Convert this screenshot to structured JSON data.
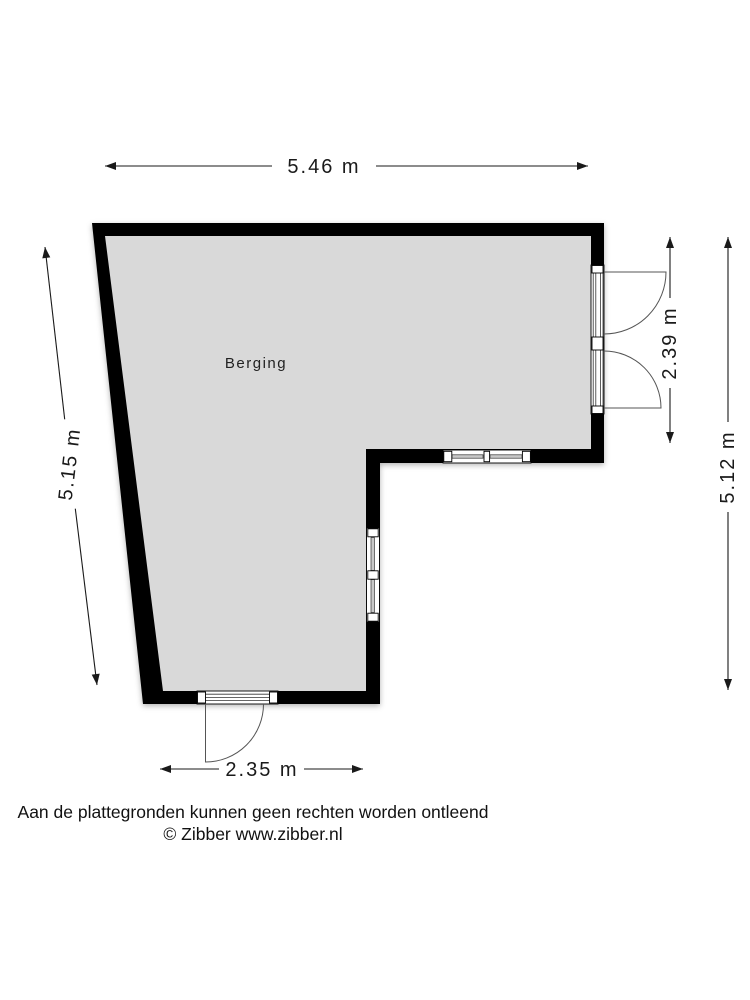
{
  "plan": {
    "room_label": "Berging",
    "colors": {
      "wall": "#000000",
      "floor": "#d9d9d9",
      "dimension": "#1a1a1a"
    },
    "dimensions": {
      "top": "5.46 m",
      "left": "5.15 m",
      "right_inner": "2.39 m",
      "right_outer": "5.12 m",
      "bottom": "2.35 m"
    },
    "features": [
      "double outward swing doors (right wall)",
      "window (inner horizontal wall)",
      "window (inner vertical wall)",
      "single outward swing door (bottom wall)"
    ]
  },
  "footer": {
    "disclaimer": "Aan de plattegronden kunnen geen rechten worden ontleend",
    "credit": "© Zibber www.zibber.nl"
  }
}
